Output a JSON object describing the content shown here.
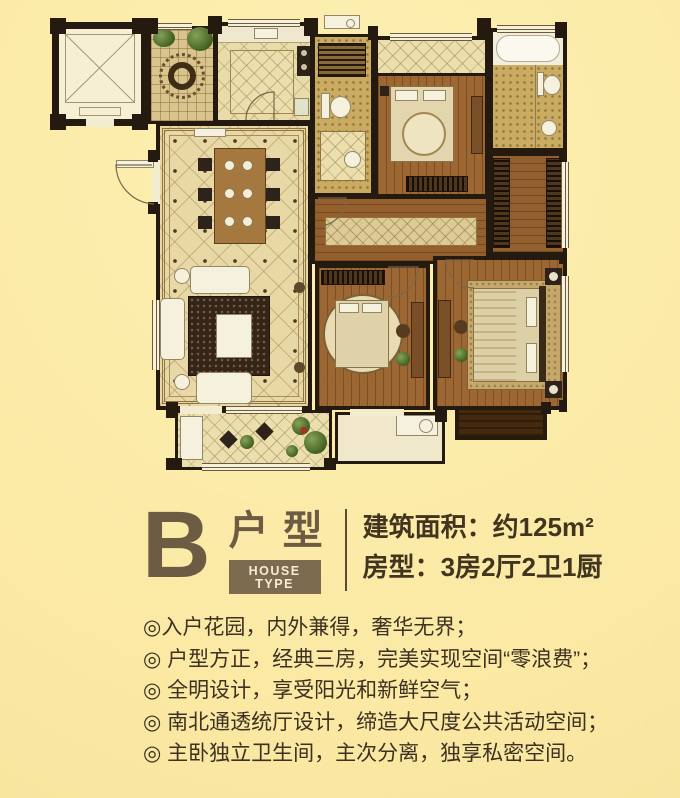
{
  "palette": {
    "page_bg": "#fbe9a4",
    "wall": "#251a10",
    "title_brown": "#6d5b44",
    "text_brown": "#3c3122",
    "badge_bg": "#7d6b50",
    "badge_text": "#f6edd2"
  },
  "unit_header": {
    "letter": "B",
    "type_cn": "户型",
    "type_en": "HOUSE TYPE",
    "area_line": "建筑面积：约125m²",
    "rooms_line": "房型：3房2厅2卫1厨"
  },
  "features": [
    "◎入户花园，内外兼得，奢华无界；",
    "◎ 户型方正，经典三房，完美实现空间“零浪费”；",
    "◎ 全明设计，享受阳光和新鲜空气；",
    "◎ 南北通透统厅设计，缔造大尺度公共活动空间；",
    "◎ 主卧独立卫生间，主次分离，独享私密空间。"
  ]
}
